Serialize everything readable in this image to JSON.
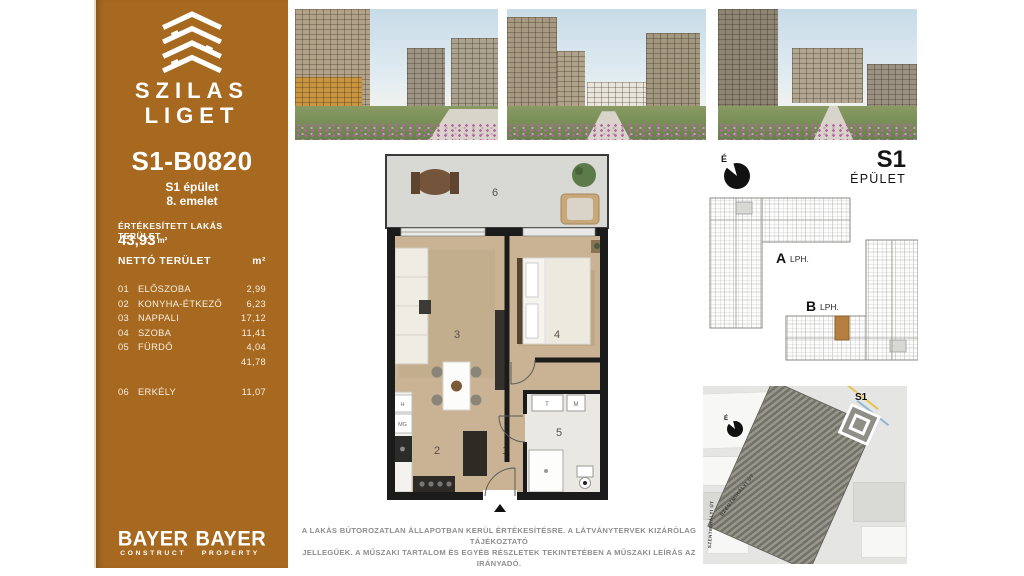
{
  "sidebar": {
    "brand": {
      "line1": "SZILAS",
      "line2": "LIGET"
    },
    "unit_id": "S1-B0820",
    "building": "S1 épület",
    "floor": "8. emelet",
    "sold_area_label": "ÉRTÉKESÍTETT LAKÁS TERÜLET",
    "sold_area_value": "43,93",
    "sold_area_unit": "m²",
    "table": {
      "header_label": "NETTÓ TERÜLET",
      "header_unit": "m²",
      "rows": [
        {
          "no": "01",
          "name": "ELŐSZOBA",
          "area": "2,99"
        },
        {
          "no": "02",
          "name": "KONYHA-ÉTKEZŐ",
          "area": "6,23"
        },
        {
          "no": "03",
          "name": "NAPPALI",
          "area": "17,12"
        },
        {
          "no": "04",
          "name": "SZOBA",
          "area": "11,41"
        },
        {
          "no": "05",
          "name": "FÜRDŐ",
          "area": "4,04"
        }
      ],
      "subtotal": "41,78",
      "balcony_row": {
        "no": "06",
        "name": "ERKÉLY",
        "area": "11,07"
      }
    },
    "logos": [
      {
        "name": "BAYER",
        "division": "CONSTRUCT"
      },
      {
        "name": "BAYER",
        "division": "PROPERTY"
      }
    ]
  },
  "floorplan": {
    "numbers": {
      "hall": "1",
      "kitchen": "2",
      "living": "3",
      "bedroom": "4",
      "bathroom": "5",
      "balcony": "6"
    },
    "appliances": {
      "fridge": "H",
      "dishwasher": "MG",
      "washer": "M",
      "sink": "T"
    }
  },
  "building_plan": {
    "north_label": "É",
    "title": "S1",
    "subtitle": "ÉPÜLET",
    "wing_a": "A",
    "wing_a_suffix": "LPH.",
    "wing_b": "B",
    "wing_b_suffix": "LPH."
  },
  "site_map": {
    "north_label": "É",
    "building_label": "S1",
    "street_1": "SZENTMIHÁLYI ÚT",
    "street_2": "SZENTMIHÁLYI ÚT"
  },
  "disclaimer": {
    "line1": "A LAKÁS BÚTOROZATLAN ÁLLAPOTBAN KERÜL ÉRTÉKESÍTÉSRE. A LÁTVÁNYTERVEK KIZÁRÓLAG TÁJÉKOZTATÓ",
    "line2": "JELLEGŰEK. A MŰSZAKI TARTALOM ÉS EGYÉB RÉSZLETEK TEKINTETÉBEN A MŰSZAKI LEÍRÁS AZ IRÁNYADÓ."
  },
  "colors": {
    "panel": "#a6691f",
    "highlight": "#b5803f",
    "wall": "#1b1b1b"
  }
}
